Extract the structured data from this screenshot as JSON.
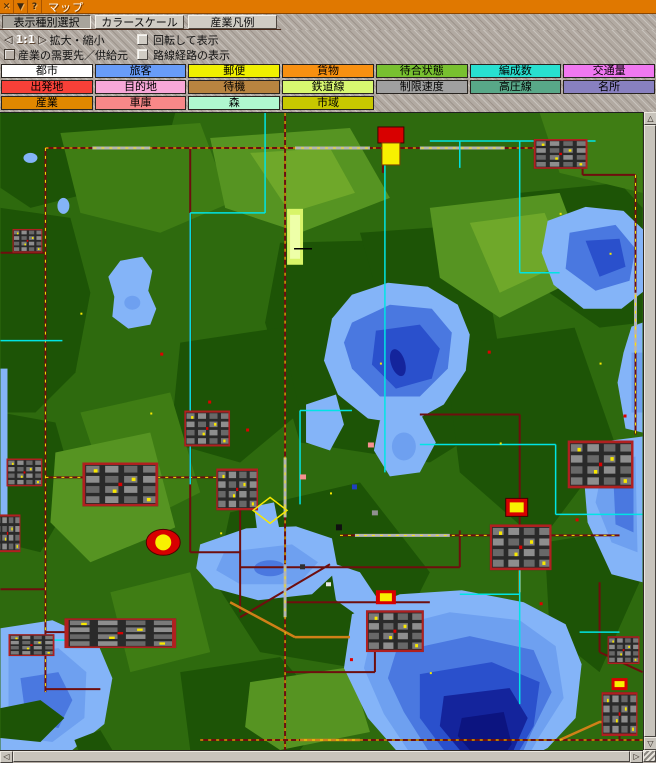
{
  "window": {
    "title": "マップ",
    "close_glyph": "✕",
    "shade_glyph": "▼",
    "help_glyph": "?"
  },
  "tabs": [
    {
      "label": "表示種別選択",
      "active": true
    },
    {
      "label": "カラースケール",
      "active": false
    },
    {
      "label": "産業凡例",
      "active": false
    }
  ],
  "controls": {
    "zoom_out_glyph": "◁",
    "zoom_level": "1:1",
    "zoom_in_glyph": "▷",
    "zoom_label": "拡大・縮小",
    "rotate_label": "回転して表示",
    "industry_links_label": "産業の需要先／供給元",
    "routes_label": "路線経路の表示"
  },
  "legend": {
    "rows": [
      [
        {
          "label": "都市",
          "color": "#ffffff"
        },
        {
          "label": "旅客",
          "color": "#689cf8"
        },
        {
          "label": "郵便",
          "color": "#f0f000"
        },
        {
          "label": "貨物",
          "color": "#f89010"
        },
        {
          "label": "待合状態",
          "color": "#78c030"
        },
        {
          "label": "編成数",
          "color": "#28e0d0"
        },
        {
          "label": "交通量",
          "color": "#f078f0"
        }
      ],
      [
        {
          "label": "出発地",
          "color": "#f84038"
        },
        {
          "label": "目的地",
          "color": "#f8a8d8"
        },
        {
          "label": "待機",
          "color": "#b88440"
        },
        {
          "label": "鉄道線",
          "color": "#d8f870"
        },
        {
          "label": "制限速度",
          "color": "#a0a0a0"
        },
        {
          "label": "高圧線",
          "color": "#58a888"
        },
        {
          "label": "名所",
          "color": "#8880c0"
        }
      ],
      [
        {
          "label": "産業",
          "color": "#e08800"
        },
        {
          "label": "車庫",
          "color": "#f88888"
        },
        {
          "label": "森",
          "color": "#b0f8d0"
        },
        {
          "label": "市域",
          "color": "#c8c800"
        }
      ]
    ]
  },
  "scrollbars": {
    "up_glyph": "△",
    "down_glyph": "▽",
    "left_glyph": "◁",
    "right_glyph": "▷"
  },
  "palette": {
    "titlebar": "#e07800",
    "panel-tex-base": "#b2aaa2",
    "button-face": "#d0ccc4",
    "button-active": "#a8a49c",
    "scroll-track": "#6e6a62",
    "scroll-face": "#c8c4bc",
    "terrain-base": "#2e6a0e",
    "terrain-dark": "#1d5406",
    "terrain-mid": "#3f7d14",
    "terrain-light": "#569422",
    "terrain-lighter": "#6fa82a",
    "tile-glow": "#d8f468",
    "tile-glow-core": "#eeffa8",
    "water-edge": "#84b4f8",
    "water-light": "#6ea0f0",
    "water-mid": "#4a78e0",
    "water-deep": "#2a50cc",
    "water-navy": "#14249c",
    "water-darkest": "#0c1480",
    "road": "#6e0e0e",
    "rail-gray": "#b4b4b4",
    "vehicle-yellow": "#f8e800",
    "road-orange": "#d08018",
    "powerline": "#00e4e4",
    "station-red": "#d80000",
    "station-yellow": "#f8f000",
    "city-building": "#7a7a7a"
  }
}
